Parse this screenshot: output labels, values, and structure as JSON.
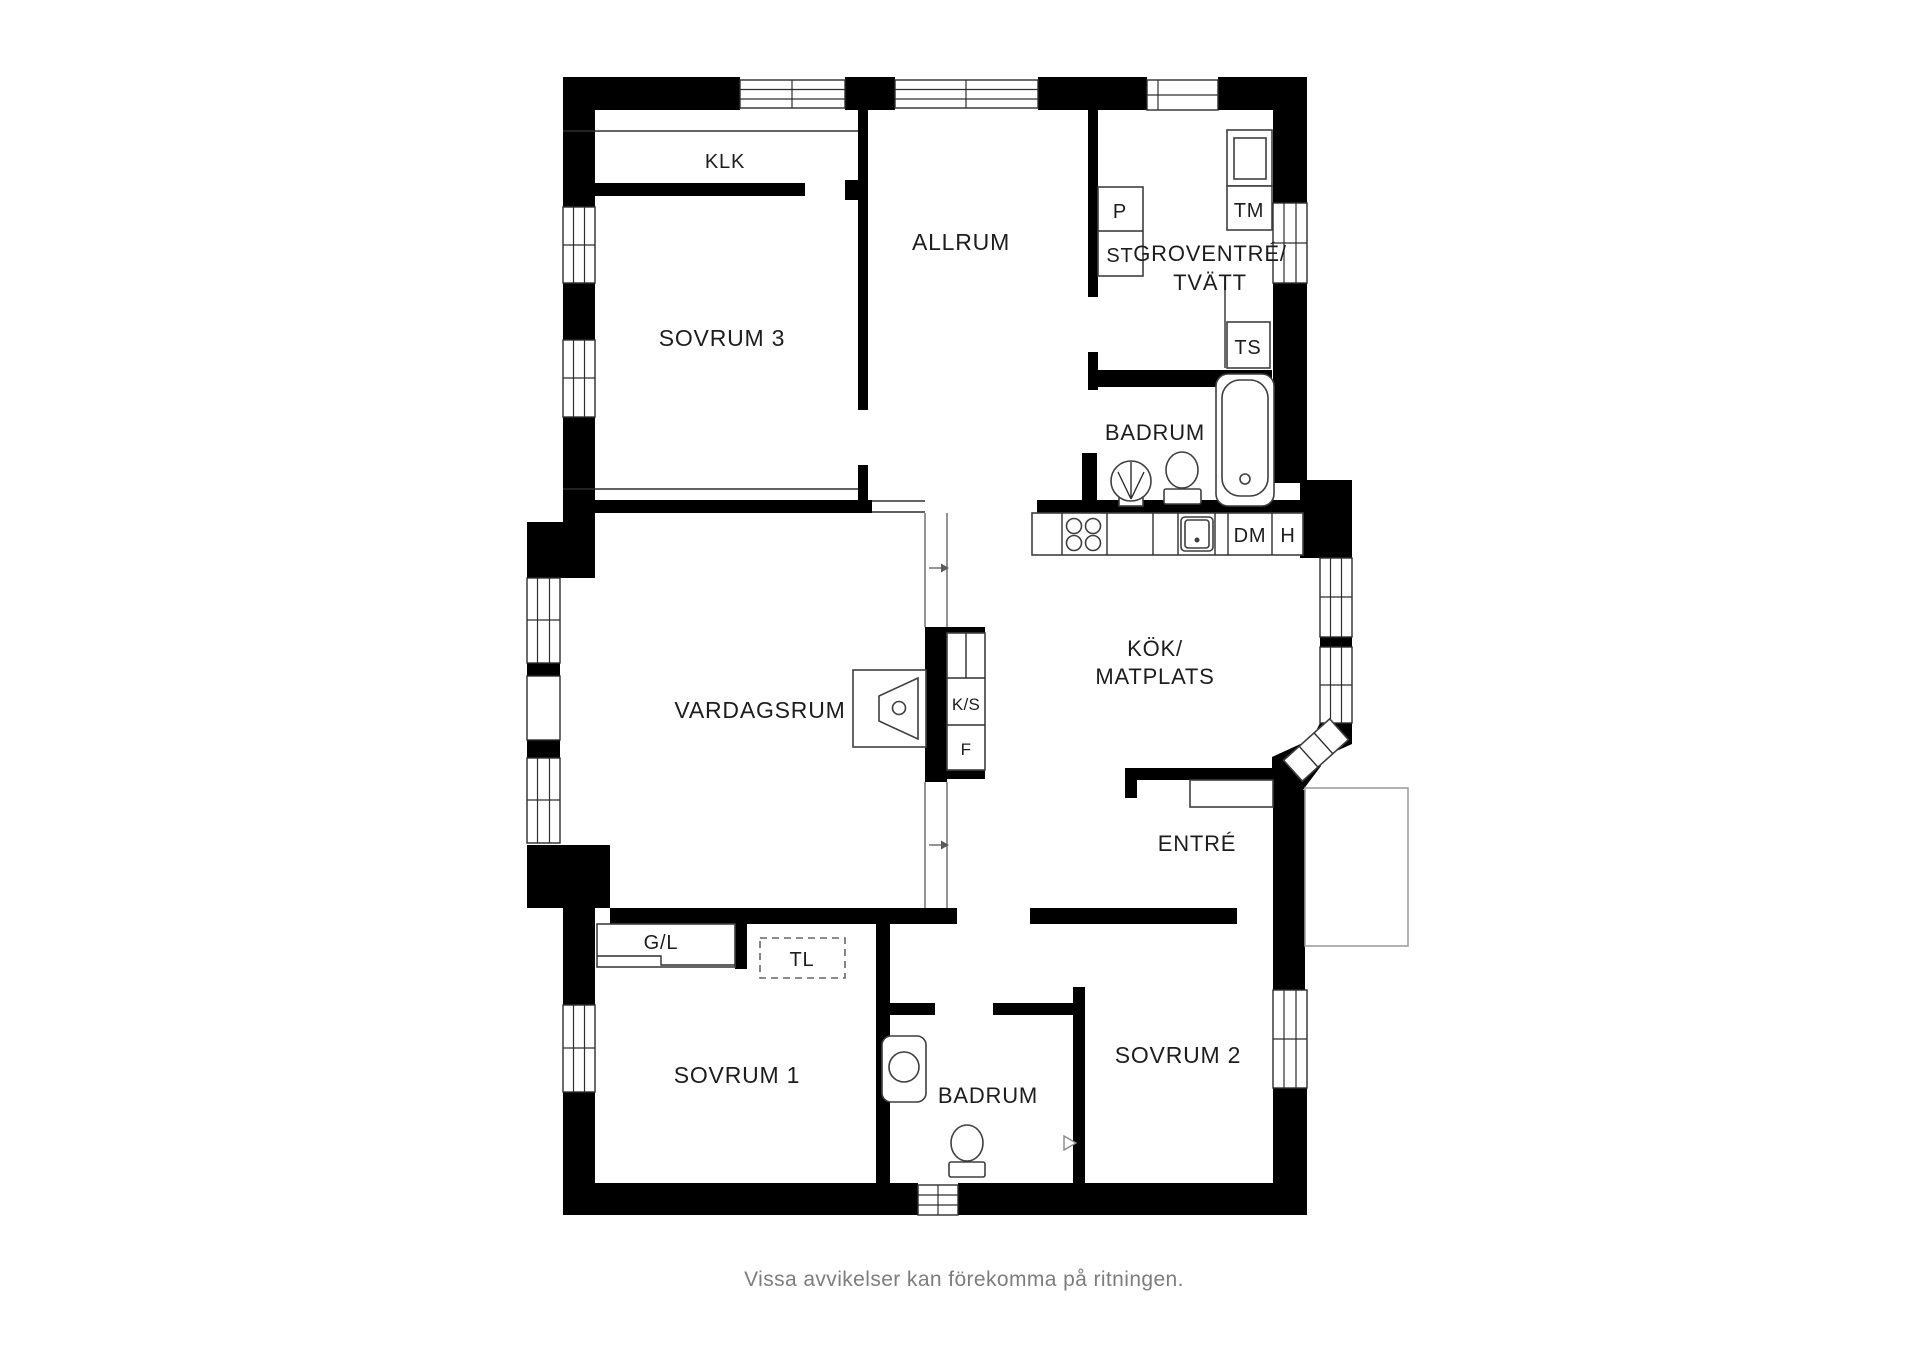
{
  "floor_plan": {
    "rooms": {
      "klk": "KLK",
      "sovrum3": "SOVRUM 3",
      "allrum": "ALLRUM",
      "groventre_line1": "GROVENTRÉ/",
      "groventre_line2": "TVÄTT",
      "badrum_top": "BADRUM",
      "vardagsrum": "VARDAGSRUM",
      "kok_line1": "KÖK/",
      "kok_line2": "MATPLATS",
      "entre": "ENTRÉ",
      "sovrum1": "SOVRUM 1",
      "badrum_bottom": "BADRUM",
      "sovrum2": "SOVRUM 2"
    },
    "fixtures": {
      "p": "P",
      "st": "ST",
      "tm": "TM",
      "ts": "TS",
      "dm": "DM",
      "h": "H",
      "ks": "K/S",
      "f": "F",
      "gl": "G/L",
      "tl": "TL"
    },
    "footer_note": "Vissa avvikelser kan förekomma på ritningen.",
    "colors": {
      "wall": "#000000",
      "label_text": "#1d1d1d",
      "fixture_outline": "#3f3f3f",
      "footer_text": "#7d7d7d",
      "background": "#ffffff"
    }
  }
}
